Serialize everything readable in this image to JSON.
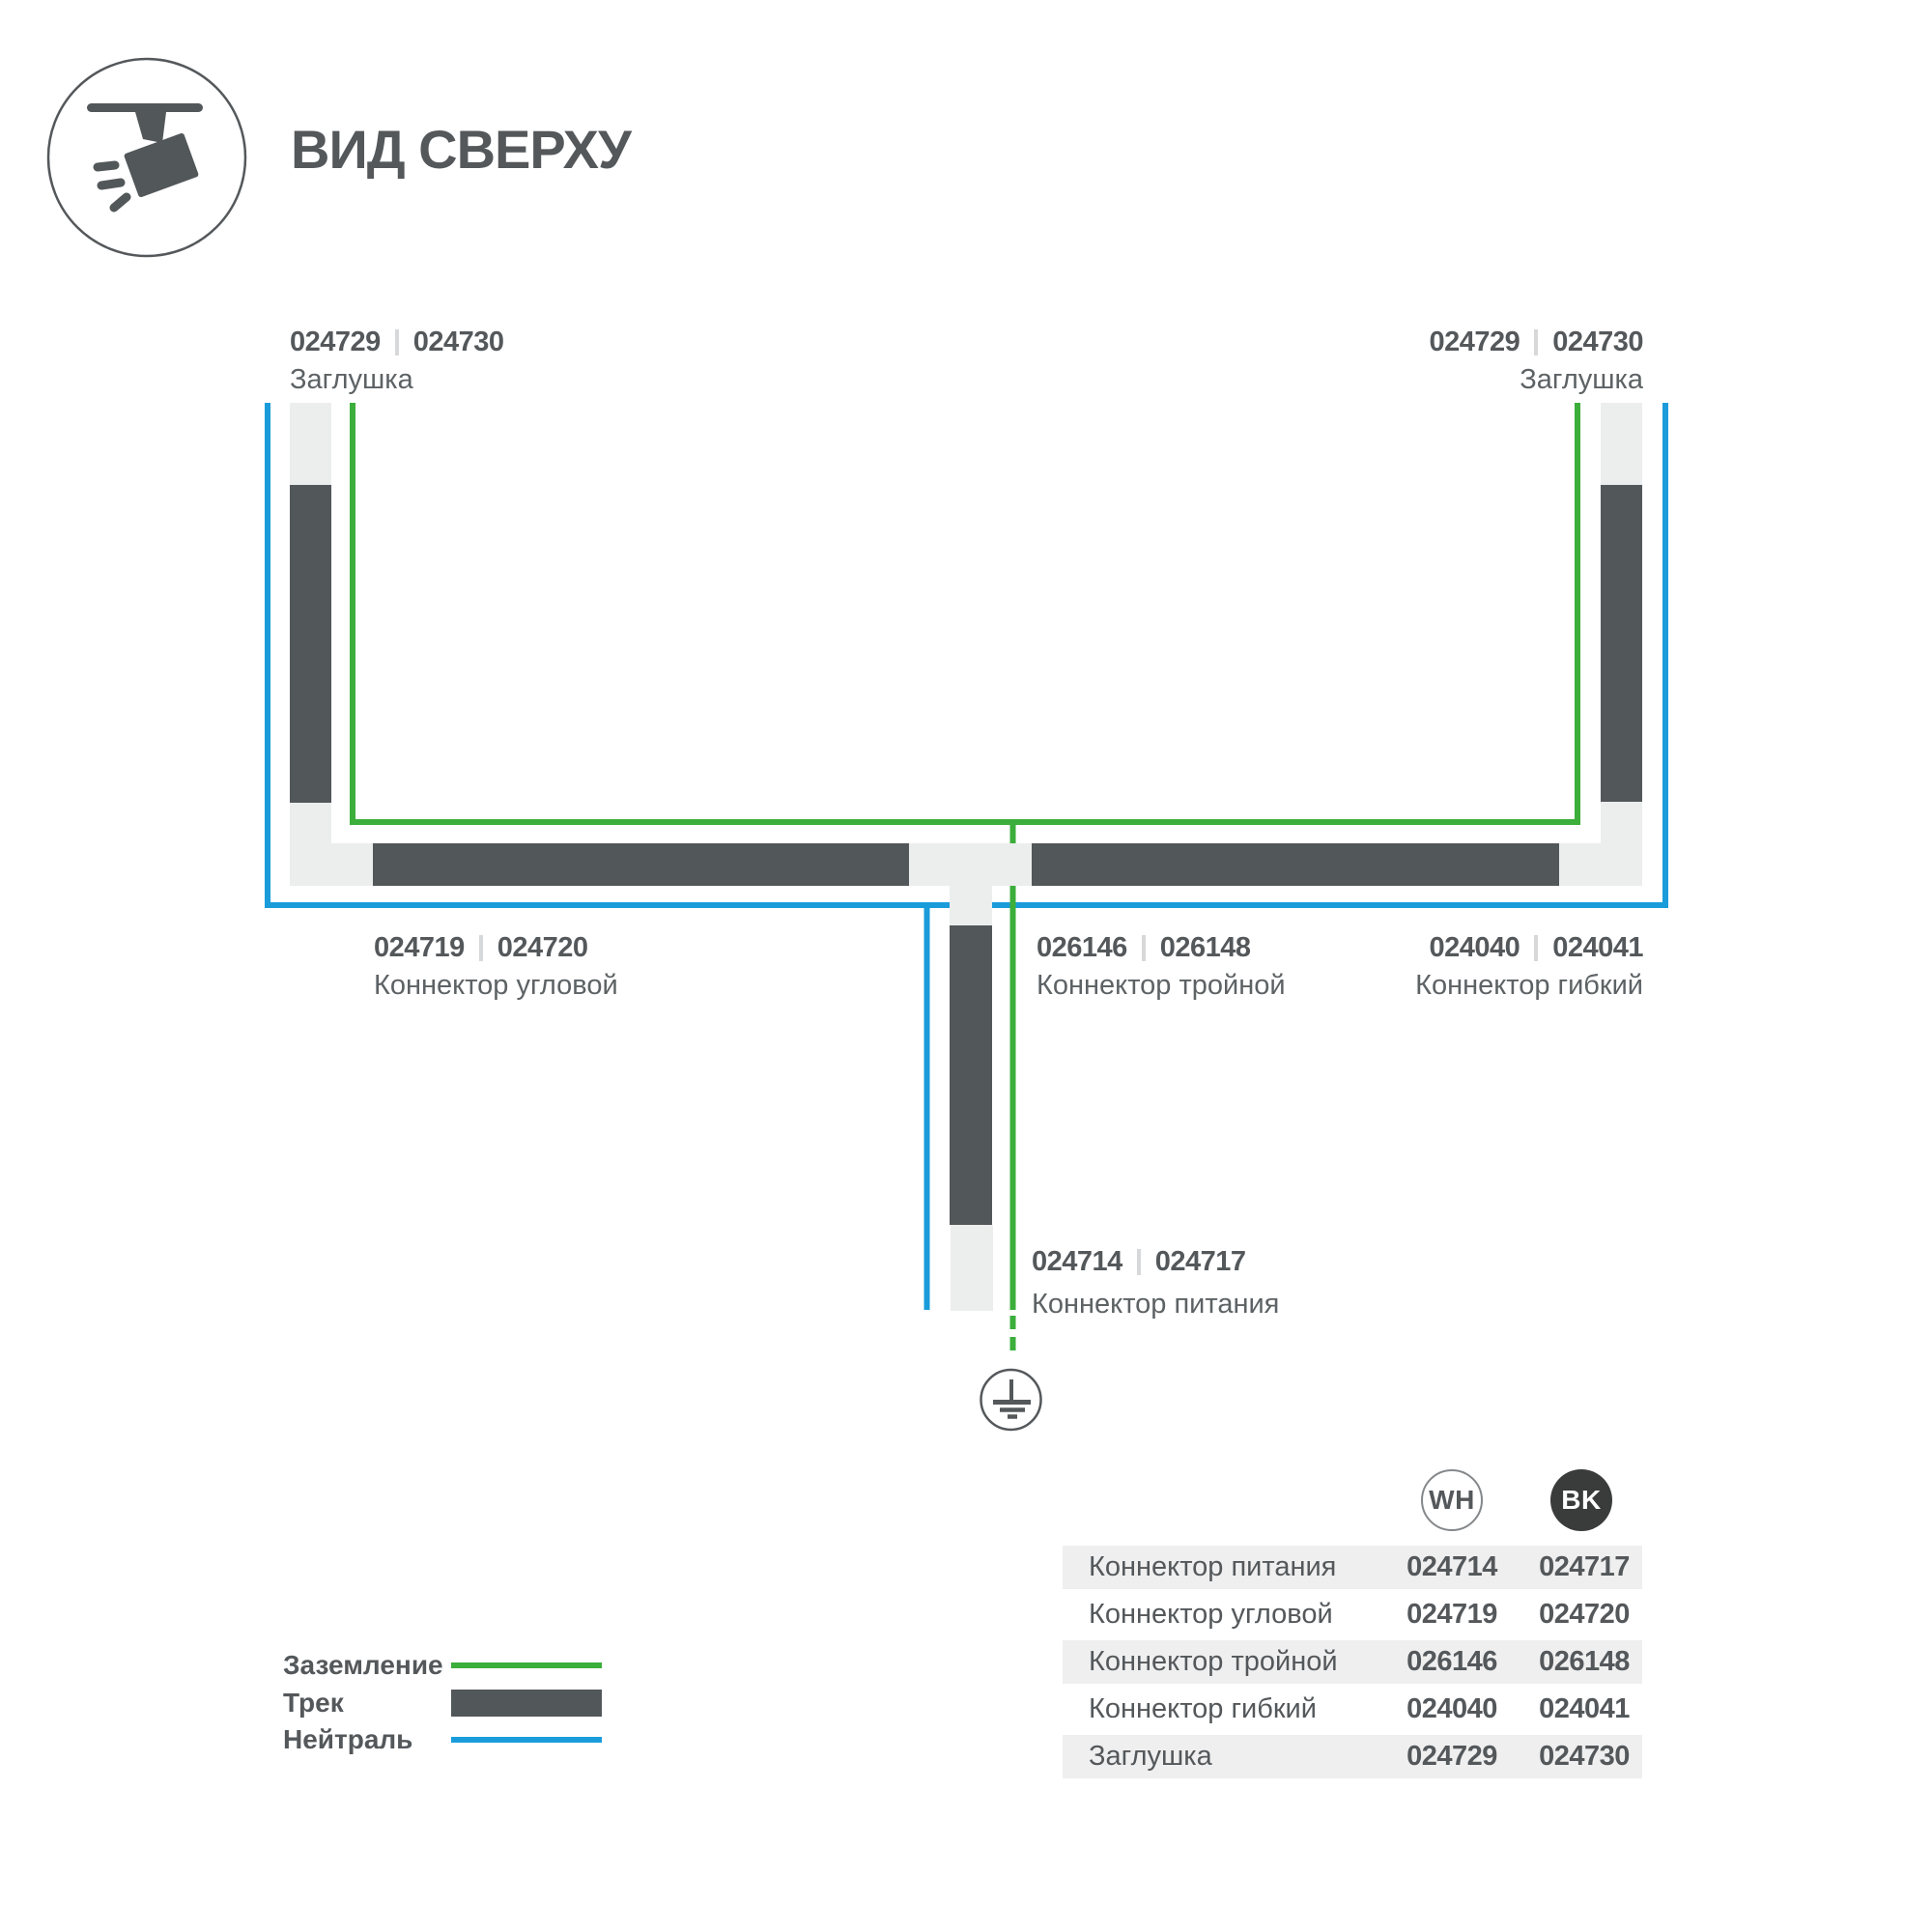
{
  "header": {
    "title": "ВИД СВЕРХУ",
    "icon": "track-spotlight"
  },
  "colors": {
    "track_dark": "#52575a",
    "connector_light": "#eceded",
    "ground_green": "#3bae3b",
    "neutral_blue": "#1a9cdb",
    "text_dark": "#54585b",
    "text_muted": "#5d6265",
    "table_row_shade": "#efefef",
    "bk_badge": "#3a3b3b"
  },
  "diagram": {
    "labels": {
      "cap_left": {
        "code_wh": "024729",
        "code_bk": "024730",
        "name": "Заглушка"
      },
      "cap_right": {
        "code_wh": "024729",
        "code_bk": "024730",
        "name": "Заглушка"
      },
      "corner": {
        "code_wh": "024719",
        "code_bk": "024720",
        "name": "Коннектор угловой"
      },
      "triple": {
        "code_wh": "026146",
        "code_bk": "026148",
        "name": "Коннектор тройной"
      },
      "flexible": {
        "code_wh": "024040",
        "code_bk": "024041",
        "name": "Коннектор гибкий"
      },
      "power": {
        "code_wh": "024714",
        "code_bk": "024717",
        "name": "Коннектор питания"
      }
    }
  },
  "legend": {
    "items": [
      {
        "label": "Заземление",
        "swatch": "green-line"
      },
      {
        "label": "Трек",
        "swatch": "dark-bar"
      },
      {
        "label": "Нейтраль",
        "swatch": "blue-line"
      }
    ]
  },
  "table": {
    "columns": [
      {
        "label": "WH"
      },
      {
        "label": "BK"
      }
    ],
    "rows": [
      {
        "name": "Коннектор питания",
        "wh": "024714",
        "bk": "024717"
      },
      {
        "name": "Коннектор угловой",
        "wh": "024719",
        "bk": "024720"
      },
      {
        "name": "Коннектор тройной",
        "wh": "026146",
        "bk": "026148"
      },
      {
        "name": "Коннектор гибкий",
        "wh": "024040",
        "bk": "024041"
      },
      {
        "name": "Заглушка",
        "wh": "024729",
        "bk": "024730"
      }
    ]
  }
}
